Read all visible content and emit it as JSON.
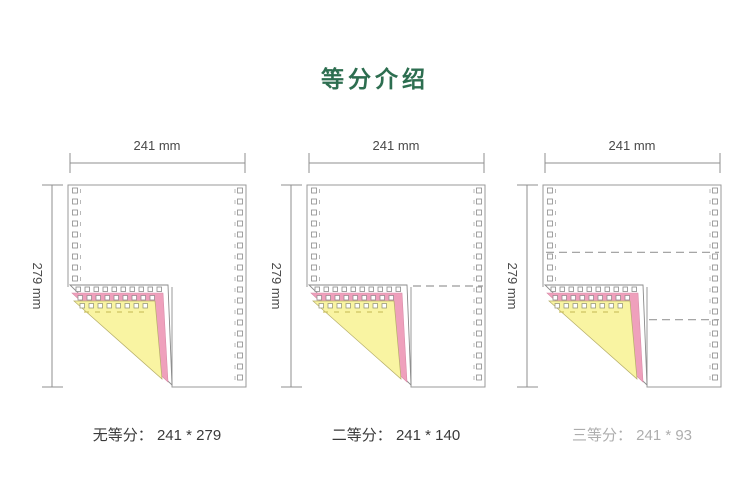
{
  "title": "等分介绍",
  "colors": {
    "title_green": "#2d6e50",
    "paper_border": "#9a9a9a",
    "dim_line": "#8f8f8f",
    "hole_outline": "#8a8a8a",
    "pink_ply": "#efa0bc",
    "yellow_ply": "#f9f4a2",
    "division_dash": "#9a9a9a",
    "yellow_perforation": "#cdc363"
  },
  "diagrams": [
    {
      "name": "no-division",
      "width_label": "241 mm",
      "height_label": "279 mm",
      "caption": "无等分： 241 * 279",
      "divisions": 1,
      "faded_caption": false
    },
    {
      "name": "two-equal-parts",
      "width_label": "241 mm",
      "height_label": "279 mm",
      "caption": "二等分： 241 * 140",
      "divisions": 2,
      "faded_caption": false
    },
    {
      "name": "three-equal-parts",
      "width_label": "241 mm",
      "height_label": "279 mm",
      "caption": "三等分： 241 * 93",
      "divisions": 3,
      "faded_caption": true
    }
  ]
}
